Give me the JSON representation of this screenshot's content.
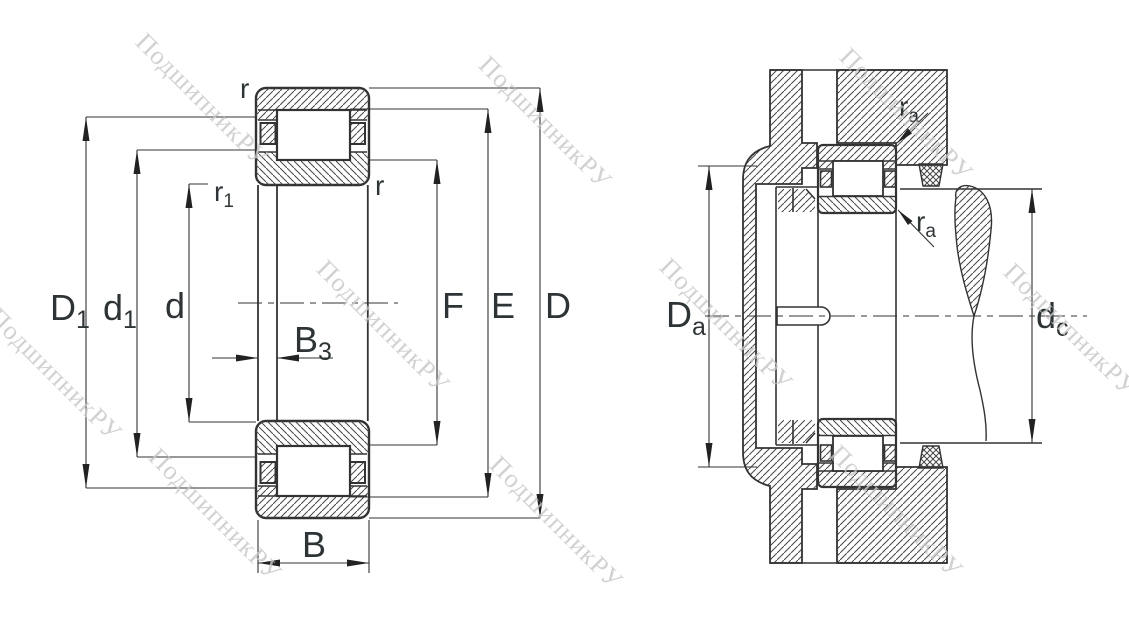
{
  "watermark": {
    "text": "ПодшипникРУ",
    "color": "#c6c6c6"
  },
  "colors": {
    "line": "#333333",
    "hatch": "#454545",
    "background": "#ffffff"
  },
  "left_view": {
    "labels": {
      "r_top": {
        "base": "r"
      },
      "r1": {
        "base": "r",
        "sub": "1"
      },
      "r_right": {
        "base": "r"
      },
      "D1": {
        "base": "D",
        "sub": "1"
      },
      "d1": {
        "base": "d",
        "sub": "1"
      },
      "d": {
        "base": "d"
      },
      "B3": {
        "base": "B",
        "sub": "3"
      },
      "B": {
        "base": "B"
      },
      "F": {
        "base": "F"
      },
      "E": {
        "base": "E"
      },
      "D": {
        "base": "D"
      }
    }
  },
  "right_view": {
    "labels": {
      "ra_top": {
        "base": "r",
        "sub": "a"
      },
      "ra_bottom": {
        "base": "r",
        "sub": "a"
      },
      "Da": {
        "base": "D",
        "sub": "a"
      },
      "dc": {
        "base": "d",
        "sub": "c"
      }
    }
  }
}
